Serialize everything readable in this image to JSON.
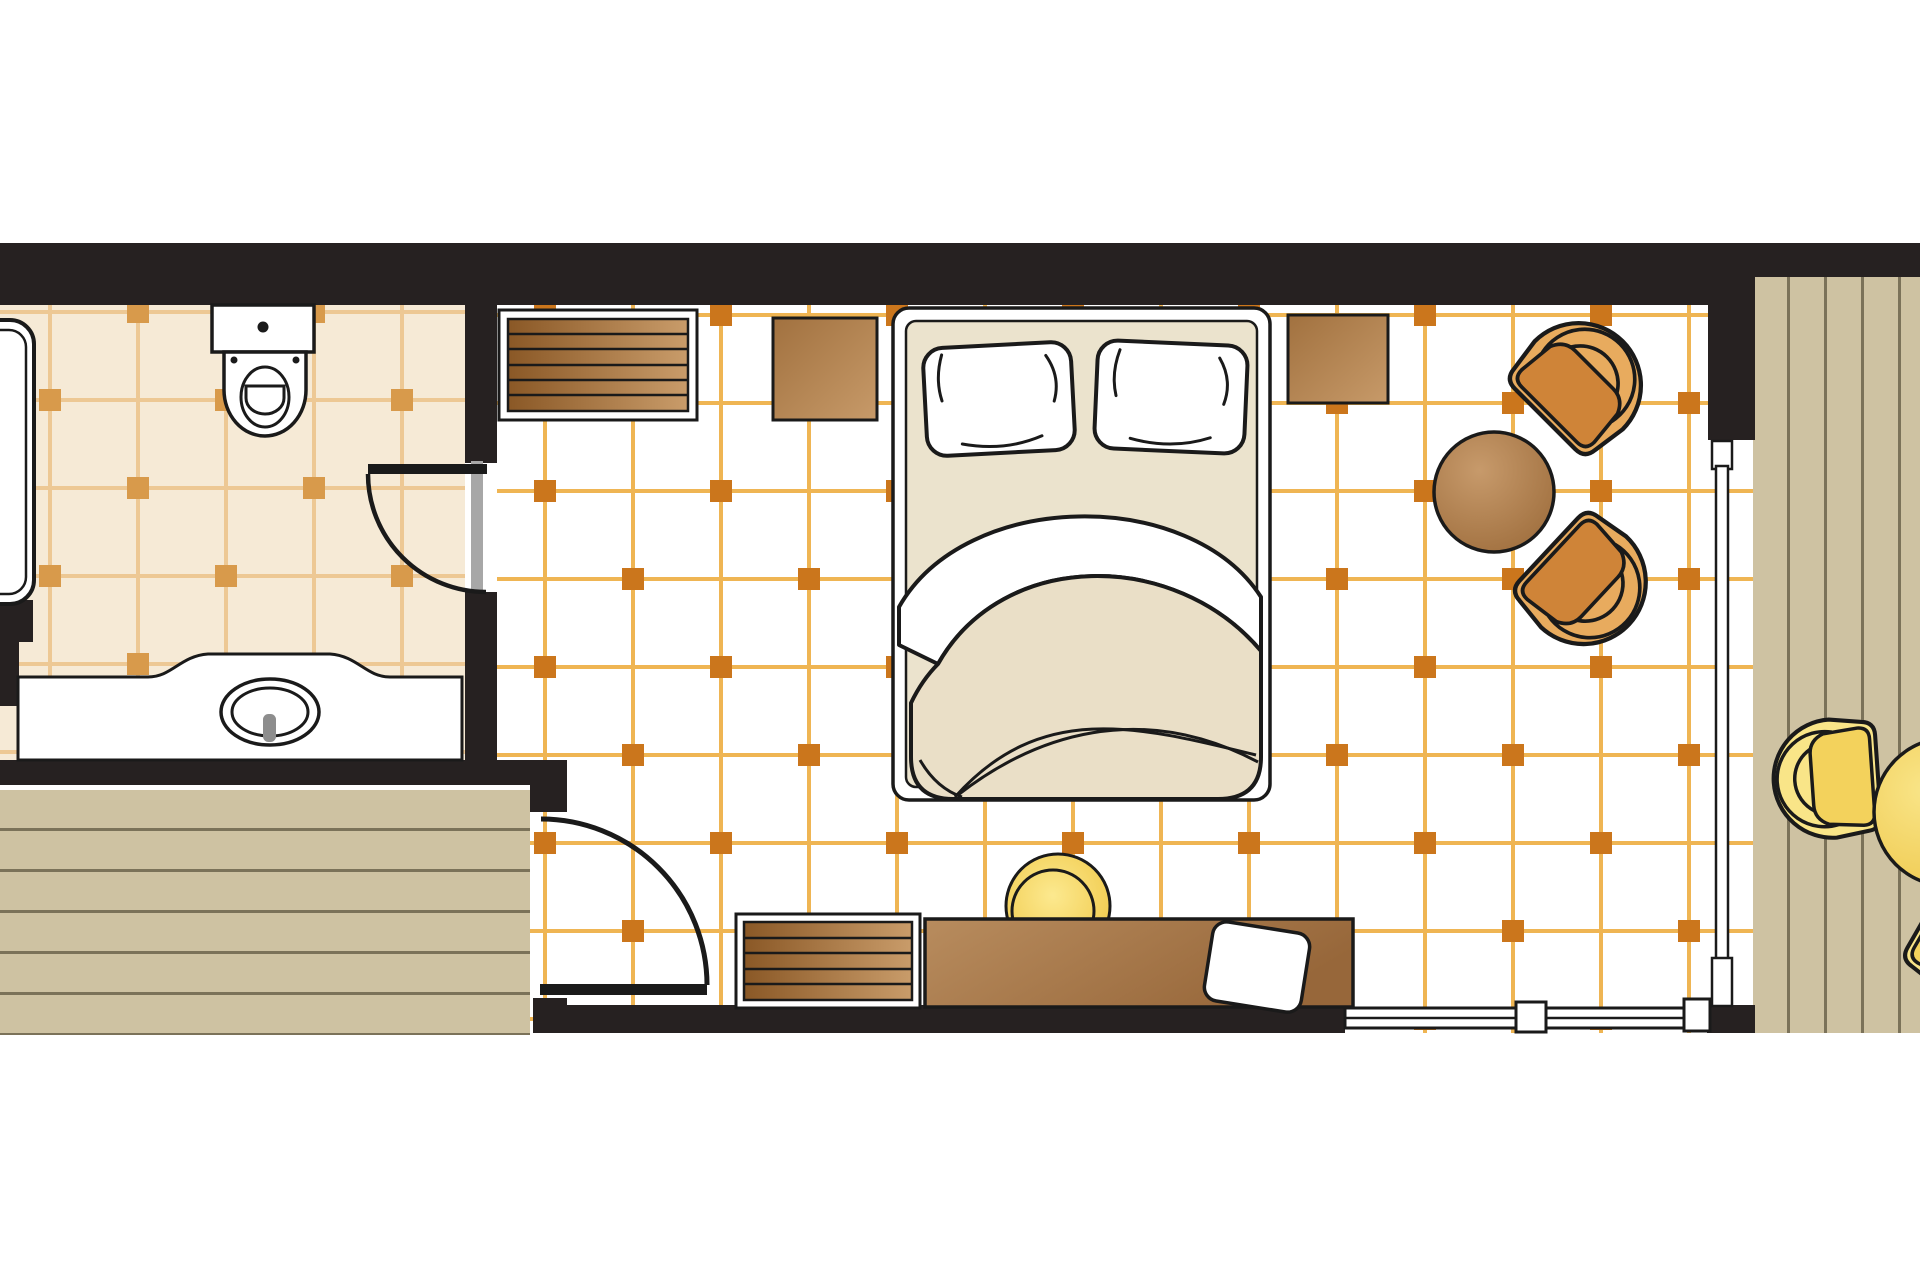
{
  "document": {
    "kind": "hotel-room-floor-plan-top-view",
    "visible_text": []
  },
  "theme": {
    "page_bg": "#ffffff",
    "wall": "#262121",
    "outline": "#1a1a1a",
    "bedroom_floor": "#ffffff",
    "bedroom_grid_line": "#efb553",
    "bedroom_grid_dot": "#cb761c",
    "bathroom_floor": "#f6ead6",
    "bathroom_grid_line": "#edc894",
    "bathroom_grid_dot": "#d89a4b",
    "deck": "#cec2a2",
    "deck_seam": "#7b7259",
    "wood_slat_dark": "#8a5826",
    "wood_slat_light": "#c99c6a",
    "nightstand_dark": "#a1713f",
    "nightstand_light": "#c79a69",
    "desk_dark": "#97673a",
    "desk_light": "#b88c5e",
    "chair_brown_light": "#e8ab5e",
    "chair_brown_dark": "#b96b28",
    "chair_yellow_light": "#f9e588",
    "chair_yellow_dark": "#eec649",
    "linen": "#ebe3cd",
    "door_jamb_gray": "#a7a7a7",
    "faucet_gray": "#8d8d8d"
  },
  "rooms": [
    {
      "name": "bathroom",
      "features": [
        "toilet",
        "bathtub",
        "vanity-sink",
        "tiled-floor"
      ]
    },
    {
      "name": "bedroom",
      "features": [
        "double-bed",
        "two-pillows",
        "duvet",
        "nightstands",
        "slatted-bench",
        "luggage-bench",
        "desk",
        "tv",
        "stool",
        "two-fan-armchairs",
        "round-table",
        "tiled-floor"
      ]
    },
    {
      "name": "entry",
      "features": [
        "wood-deck-floor",
        "entrance-door-swing"
      ]
    },
    {
      "name": "balcony",
      "features": [
        "wood-plank-deck",
        "two-yellow-fan-chairs",
        "yellow-round-table",
        "sliding-glass-door",
        "window-band"
      ]
    }
  ]
}
